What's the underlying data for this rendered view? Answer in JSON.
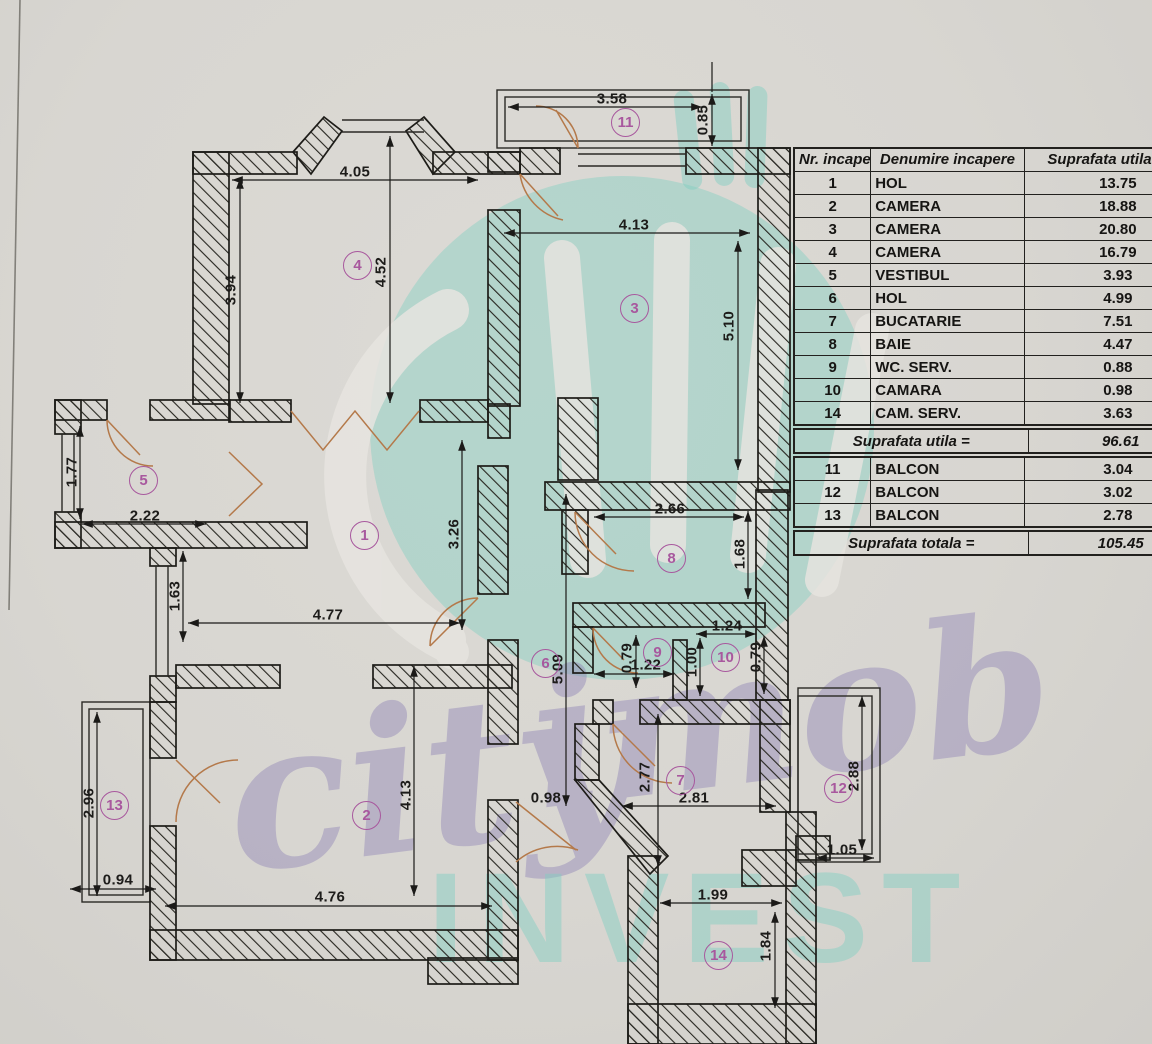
{
  "document": {
    "kind": "scanned apartment floor plan with room area table",
    "accent_colors": {
      "wall_ink": "#22211e",
      "room_badge": "#a8589e",
      "door_arc": "#b4794a",
      "watermark_teal": "#8fd2c5",
      "watermark_purple": "#9e92c2",
      "paper": "#d8d6d1"
    }
  },
  "watermark": {
    "word1": "city",
    "word2": "imob",
    "word3": "INVEST"
  },
  "table": {
    "headers": [
      "Nr. incapere",
      "Denumire incapere",
      "Suprafata utila [mp]"
    ],
    "rows": [
      {
        "nr": "1",
        "name": "HOL",
        "area": "13.75"
      },
      {
        "nr": "2",
        "name": "CAMERA",
        "area": "18.88"
      },
      {
        "nr": "3",
        "name": "CAMERA",
        "area": "20.80"
      },
      {
        "nr": "4",
        "name": "CAMERA",
        "area": "16.79"
      },
      {
        "nr": "5",
        "name": "VESTIBUL",
        "area": "3.93"
      },
      {
        "nr": "6",
        "name": "HOL",
        "area": "4.99"
      },
      {
        "nr": "7",
        "name": "BUCATARIE",
        "area": "7.51"
      },
      {
        "nr": "8",
        "name": "BAIE",
        "area": "4.47"
      },
      {
        "nr": "9",
        "name": "WC. SERV.",
        "area": "0.88"
      },
      {
        "nr": "10",
        "name": "CAMARA",
        "area": "0.98"
      },
      {
        "nr": "14",
        "name": "CAM. SERV.",
        "area": "3.63"
      }
    ],
    "subtotal_label": "Suprafata utila =",
    "subtotal_value": "96.61",
    "balconies": [
      {
        "nr": "11",
        "name": "BALCON",
        "area": "3.04"
      },
      {
        "nr": "12",
        "name": "BALCON",
        "area": "3.02"
      },
      {
        "nr": "13",
        "name": "BALCON",
        "area": "2.78"
      }
    ],
    "total_label": "Suprafata totala =",
    "total_value": "105.45"
  },
  "plan": {
    "room_labels": [
      {
        "n": "1"
      },
      {
        "n": "2"
      },
      {
        "n": "3"
      },
      {
        "n": "4"
      },
      {
        "n": "5"
      },
      {
        "n": "6"
      },
      {
        "n": "7"
      },
      {
        "n": "8"
      },
      {
        "n": "9"
      },
      {
        "n": "10"
      },
      {
        "n": "11"
      },
      {
        "n": "12"
      },
      {
        "n": "13"
      },
      {
        "n": "14"
      }
    ],
    "dims": [
      "4.05",
      "3.94",
      "4.52",
      "3.58",
      "0.85",
      "4.13",
      "5.10",
      "1.77",
      "2.22",
      "1.63",
      "4.77",
      "3.26",
      "2.66",
      "1.68",
      "5.09",
      "0.79",
      "1.22",
      "1.24",
      "1.00",
      "0.79",
      "2.96",
      "0.94",
      "4.13",
      "4.76",
      "0.98",
      "2.77",
      "2.81",
      "1.05",
      "2.88",
      "1.99",
      "1.84"
    ]
  }
}
